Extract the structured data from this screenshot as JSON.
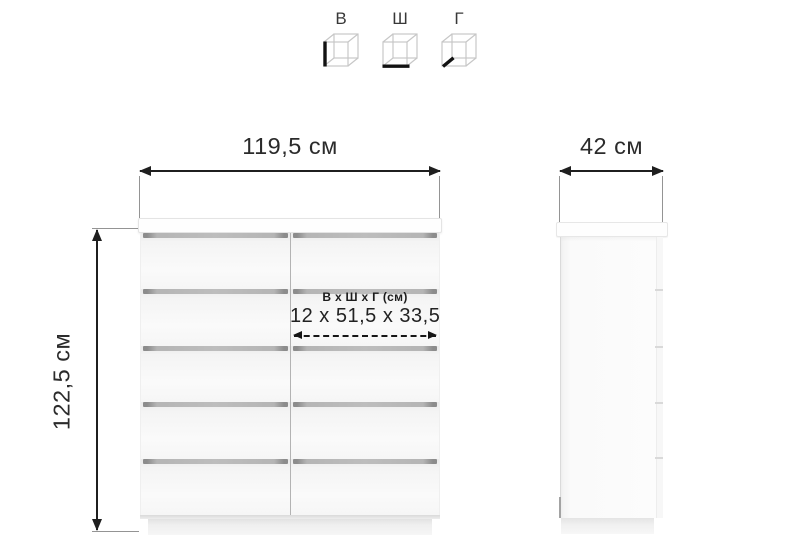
{
  "legend": {
    "items": [
      {
        "label": "В",
        "meaning": "height"
      },
      {
        "label": "Ш",
        "meaning": "width"
      },
      {
        "label": "Г",
        "meaning": "depth"
      }
    ]
  },
  "front_view": {
    "width_label": "119,5 см",
    "height_label": "122,5 см",
    "drawer_rows": 5,
    "drawer_columns": 2,
    "annotation": {
      "title": "В х Ш х Г (см)",
      "value": "12 х 51,5 х 33,5"
    }
  },
  "side_view": {
    "depth_label": "42 см"
  },
  "colors": {
    "dimension_line": "#1f1f1f",
    "extension_line": "#949494",
    "drawer_gap": "#b5b5b5",
    "background": "#ffffff"
  }
}
